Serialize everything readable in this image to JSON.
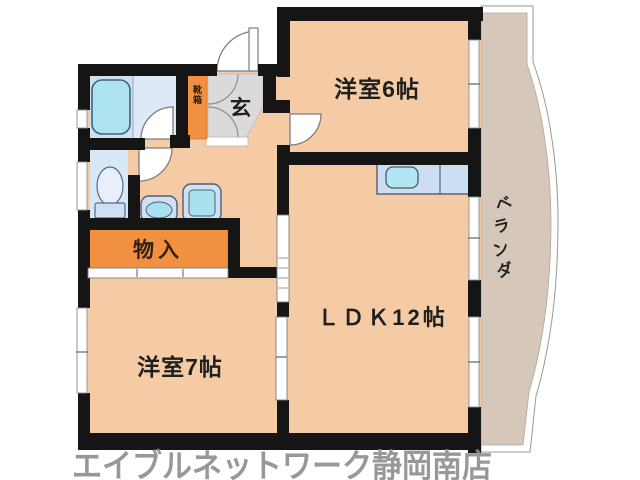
{
  "floorplan": {
    "rooms": {
      "western6": "洋室6帖",
      "western7": "洋室7帖",
      "ldk": "ＬＤＫ12帖",
      "entrance": "玄",
      "shoebox": "靴箱",
      "storage": "物入"
    },
    "balcony": {
      "label": "ベランダ",
      "chars": [
        "ベ",
        "ラ",
        "ン",
        "ダ"
      ]
    },
    "watermark": "エイブルネットワーク静岡南店",
    "colors": {
      "room_floor": "#f4cba5",
      "balcony_floor": "#d5c8ba",
      "storage_accent": "#f09040",
      "entrance_floor": "#dadada",
      "wet_room_blue": "#d8e7f6",
      "fixture_cyan": "#ace3ef",
      "counter_blue": "#ccdff2",
      "wall_black": "#151515",
      "watermark_gray": "#8a8a8a"
    }
  }
}
